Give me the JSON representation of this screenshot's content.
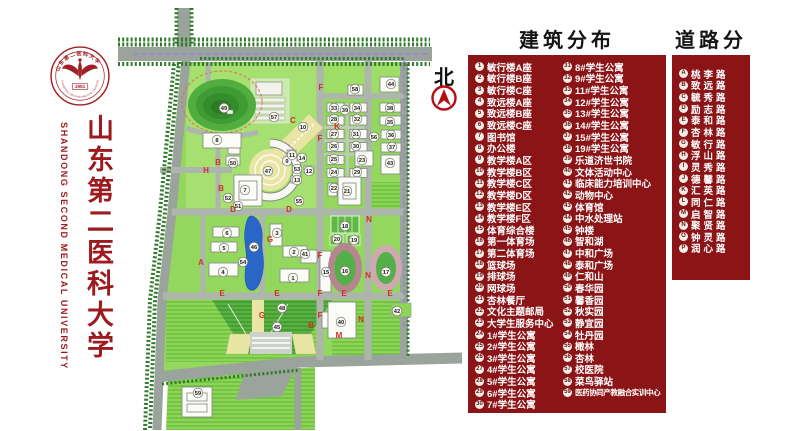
{
  "brand": {
    "logo": {
      "year": "1951",
      "ring_top": "山东第二医科大学",
      "ring_bottom": "SHANDONG SECOND MEDICAL UNIVERSITY"
    },
    "title_cn": "山东第二医科大学",
    "title_en": "SHANDONG SECOND MEDICAL UNIVERSITY"
  },
  "colors": {
    "panel_red": "#8b1417",
    "brand_red": "#9c1b1e",
    "road_letter_red": "#d03020",
    "lake_blue": "#2a66c8"
  },
  "map": {
    "north_label": "北",
    "markers": [
      {
        "n": 1,
        "x": 293,
        "y": 278
      },
      {
        "n": 2,
        "x": 294,
        "y": 252
      },
      {
        "n": 3,
        "x": 277,
        "y": 233
      },
      {
        "n": 4,
        "x": 223,
        "y": 272
      },
      {
        "n": 5,
        "x": 224,
        "y": 248
      },
      {
        "n": 6,
        "x": 227,
        "y": 233
      },
      {
        "n": 7,
        "x": 245,
        "y": 190
      },
      {
        "n": 8,
        "x": 217,
        "y": 140
      },
      {
        "n": 9,
        "x": 287,
        "y": 161
      },
      {
        "n": 10,
        "x": 303,
        "y": 127
      },
      {
        "n": 11,
        "x": 292,
        "y": 155
      },
      {
        "n": 12,
        "x": 309,
        "y": 171
      },
      {
        "n": 13,
        "x": 297,
        "y": 180
      },
      {
        "n": 14,
        "x": 302,
        "y": 158
      },
      {
        "n": 15,
        "x": 326,
        "y": 272
      },
      {
        "n": 16,
        "x": 345,
        "y": 271
      },
      {
        "n": 17,
        "x": 386,
        "y": 272
      },
      {
        "n": 18,
        "x": 345,
        "y": 226
      },
      {
        "n": 19,
        "x": 354,
        "y": 240
      },
      {
        "n": 20,
        "x": 337,
        "y": 239
      },
      {
        "n": 21,
        "x": 347,
        "y": 191
      },
      {
        "n": 22,
        "x": 334,
        "y": 188
      },
      {
        "n": 23,
        "x": 362,
        "y": 160
      },
      {
        "n": 24,
        "x": 334,
        "y": 172
      },
      {
        "n": 25,
        "x": 334,
        "y": 159
      },
      {
        "n": 26,
        "x": 334,
        "y": 146
      },
      {
        "n": 27,
        "x": 334,
        "y": 134
      },
      {
        "n": 28,
        "x": 334,
        "y": 119
      },
      {
        "n": 29,
        "x": 357,
        "y": 172
      },
      {
        "n": 30,
        "x": 356,
        "y": 146
      },
      {
        "n": 31,
        "x": 356,
        "y": 134
      },
      {
        "n": 32,
        "x": 357,
        "y": 119
      },
      {
        "n": 33,
        "x": 334,
        "y": 108
      },
      {
        "n": 34,
        "x": 357,
        "y": 108
      },
      {
        "n": 35,
        "x": 390,
        "y": 122
      },
      {
        "n": 36,
        "x": 391,
        "y": 135
      },
      {
        "n": 37,
        "x": 392,
        "y": 147
      },
      {
        "n": 38,
        "x": 390,
        "y": 108
      },
      {
        "n": 39,
        "x": 345,
        "y": 110
      },
      {
        "n": 40,
        "x": 341,
        "y": 322
      },
      {
        "n": 41,
        "x": 305,
        "y": 254
      },
      {
        "n": 42,
        "x": 397,
        "y": 311
      },
      {
        "n": 43,
        "x": 390,
        "y": 163
      },
      {
        "n": 44,
        "x": 391,
        "y": 84
      },
      {
        "n": 45,
        "x": 277,
        "y": 327
      },
      {
        "n": 46,
        "x": 254,
        "y": 247
      },
      {
        "n": 47,
        "x": 268,
        "y": 171
      },
      {
        "n": 48,
        "x": 282,
        "y": 308
      },
      {
        "n": 49,
        "x": 224,
        "y": 108
      },
      {
        "n": 50,
        "x": 233,
        "y": 163
      },
      {
        "n": 51,
        "x": 238,
        "y": 206
      },
      {
        "n": 52,
        "x": 228,
        "y": 198
      },
      {
        "n": 53,
        "x": 297,
        "y": 169
      },
      {
        "n": 54,
        "x": 243,
        "y": 262
      },
      {
        "n": 55,
        "x": 299,
        "y": 201
      },
      {
        "n": 56,
        "x": 374,
        "y": 137
      },
      {
        "n": 57,
        "x": 274,
        "y": 117
      },
      {
        "n": 58,
        "x": 355,
        "y": 89
      },
      {
        "n": 59,
        "x": 198,
        "y": 393
      }
    ],
    "road_letters": [
      {
        "k": "F",
        "x": 321,
        "y": 90
      },
      {
        "k": "C",
        "x": 293,
        "y": 123
      },
      {
        "k": "K",
        "x": 337,
        "y": 129
      },
      {
        "k": "F",
        "x": 320,
        "y": 141
      },
      {
        "k": "H",
        "x": 206,
        "y": 173
      },
      {
        "k": "B",
        "x": 218,
        "y": 165
      },
      {
        "k": "B",
        "x": 221,
        "y": 191
      },
      {
        "k": "D",
        "x": 233,
        "y": 212
      },
      {
        "k": "D",
        "x": 289,
        "y": 212
      },
      {
        "k": "G",
        "x": 270,
        "y": 242
      },
      {
        "k": "N",
        "x": 369,
        "y": 222
      },
      {
        "k": "F",
        "x": 320,
        "y": 258
      },
      {
        "k": "N",
        "x": 368,
        "y": 278
      },
      {
        "k": "A",
        "x": 201,
        "y": 265
      },
      {
        "k": "E",
        "x": 222,
        "y": 296
      },
      {
        "k": "E",
        "x": 277,
        "y": 296
      },
      {
        "k": "F",
        "x": 320,
        "y": 296
      },
      {
        "k": "E",
        "x": 344,
        "y": 296
      },
      {
        "k": "E",
        "x": 390,
        "y": 296
      },
      {
        "k": "G",
        "x": 262,
        "y": 318
      },
      {
        "k": "F",
        "x": 320,
        "y": 318
      },
      {
        "k": "B",
        "x": 311,
        "y": 328
      },
      {
        "k": "N",
        "x": 361,
        "y": 322
      },
      {
        "k": "M",
        "x": 339,
        "y": 338
      }
    ]
  },
  "legend_buildings": {
    "title": "建筑分布",
    "items": [
      {
        "num": "1",
        "label": "敏行楼A座"
      },
      {
        "num": "2",
        "label": "敏行楼B座"
      },
      {
        "num": "3",
        "label": "敏行楼C座"
      },
      {
        "num": "4",
        "label": "致远楼A座"
      },
      {
        "num": "5",
        "label": "致远楼B座"
      },
      {
        "num": "6",
        "label": "致远楼C座"
      },
      {
        "num": "7",
        "label": "图书馆"
      },
      {
        "num": "8",
        "label": "办公楼"
      },
      {
        "num": "9",
        "label": "教学楼A区"
      },
      {
        "num": "10",
        "label": "教学楼B区"
      },
      {
        "num": "11",
        "label": "教学楼C区"
      },
      {
        "num": "12",
        "label": "教学楼D区"
      },
      {
        "num": "13",
        "label": "教学楼E区"
      },
      {
        "num": "14",
        "label": "教学楼F区"
      },
      {
        "num": "15",
        "label": "体育综合楼"
      },
      {
        "num": "16",
        "label": "第一体育场"
      },
      {
        "num": "17",
        "label": "第二体育场"
      },
      {
        "num": "18",
        "label": "篮球场"
      },
      {
        "num": "19",
        "label": "排球场"
      },
      {
        "num": "20",
        "label": "网球场"
      },
      {
        "num": "21",
        "label": "杏林餐厅"
      },
      {
        "num": "22",
        "label": "文化主题邮局"
      },
      {
        "num": "23",
        "label": "大学生服务中心"
      },
      {
        "num": "24",
        "label": "1#学生公寓"
      },
      {
        "num": "25",
        "label": "2#学生公寓"
      },
      {
        "num": "26",
        "label": "3#学生公寓"
      },
      {
        "num": "27",
        "label": "4#学生公寓"
      },
      {
        "num": "28",
        "label": "5#学生公寓"
      },
      {
        "num": "29",
        "label": "6#学生公寓"
      },
      {
        "num": "30",
        "label": "7#学生公寓"
      },
      {
        "num": "31",
        "label": "8#学生公寓"
      },
      {
        "num": "32",
        "label": "9#学生公寓"
      },
      {
        "num": "33",
        "label": "11#学生公寓"
      },
      {
        "num": "34",
        "label": "12#学生公寓"
      },
      {
        "num": "35",
        "label": "13#学生公寓"
      },
      {
        "num": "36",
        "label": "14#学生公寓"
      },
      {
        "num": "37",
        "label": "15#学生公寓"
      },
      {
        "num": "38",
        "label": "19#学生公寓"
      },
      {
        "num": "39",
        "label": "乐道济世书院"
      },
      {
        "num": "40",
        "label": "文体活动中心"
      },
      {
        "num": "41",
        "label": "临床能力培训中心"
      },
      {
        "num": "42",
        "label": "动物中心"
      },
      {
        "num": "43",
        "label": "体育馆"
      },
      {
        "num": "44",
        "label": "中水处理站"
      },
      {
        "num": "45",
        "label": "钟楼"
      },
      {
        "num": "46",
        "label": "智和湖"
      },
      {
        "num": "47",
        "label": "中和广场"
      },
      {
        "num": "48",
        "label": "泰和广场"
      },
      {
        "num": "49",
        "label": "仁和山"
      },
      {
        "num": "50",
        "label": "春华园"
      },
      {
        "num": "51",
        "label": "馨香园"
      },
      {
        "num": "52",
        "label": "秋实园"
      },
      {
        "num": "53",
        "label": "静宜园"
      },
      {
        "num": "54",
        "label": "牡丹园"
      },
      {
        "num": "55",
        "label": "橄林"
      },
      {
        "num": "56",
        "label": "杏林"
      },
      {
        "num": "57",
        "label": "校医院"
      },
      {
        "num": "58",
        "label": "菜鸟驿站"
      },
      {
        "num": "59",
        "label": "医药协同产教融合实训中心"
      }
    ]
  },
  "legend_roads": {
    "title": "道路分布",
    "items": [
      {
        "key": "A",
        "label": "桃李路"
      },
      {
        "key": "B",
        "label": "致远路"
      },
      {
        "key": "C",
        "label": "毓秀路"
      },
      {
        "key": "D",
        "label": "励志路"
      },
      {
        "key": "E",
        "label": "泰和路"
      },
      {
        "key": "F",
        "label": "杏林路"
      },
      {
        "key": "G",
        "label": "敏行路"
      },
      {
        "key": "H",
        "label": "浮山路"
      },
      {
        "key": "I",
        "label": "灵秀路"
      },
      {
        "key": "J",
        "label": "德馨路"
      },
      {
        "key": "K",
        "label": "汇英路"
      },
      {
        "key": "L",
        "label": "同仁路"
      },
      {
        "key": "M",
        "label": "启智路"
      },
      {
        "key": "N",
        "label": "聚贤路"
      },
      {
        "key": "O",
        "label": "钟灵路"
      },
      {
        "key": "P",
        "label": "润心路"
      }
    ]
  }
}
